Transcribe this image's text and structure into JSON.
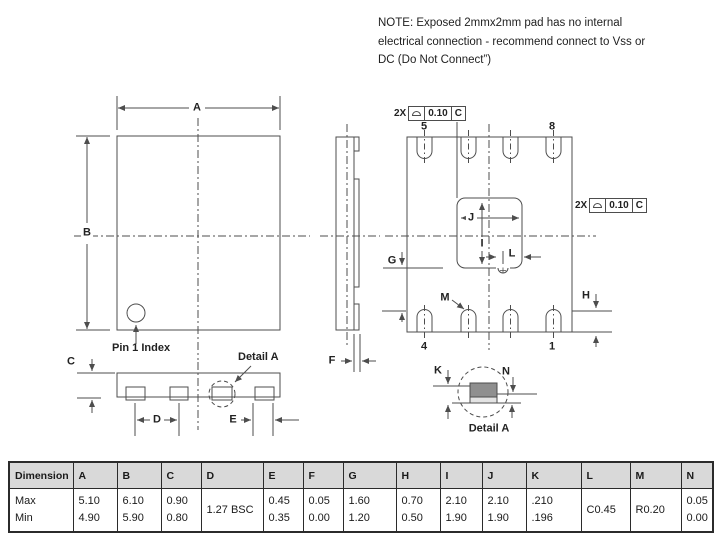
{
  "note": {
    "line1": "NOTE:  Exposed 2mmx2mm pad has no internal",
    "line2": "electrical connection - recommend connect to Vss or",
    "line3": "DC (Do Not Connect”)"
  },
  "drawing": {
    "labels": {
      "a": "A",
      "b": "B",
      "c": "C",
      "d": "D",
      "e": "E",
      "f": "F",
      "g": "G",
      "h": "H",
      "i": "I",
      "j": "J",
      "k": "K",
      "l": "L",
      "m": "M",
      "n": "N"
    },
    "pins": {
      "p1": "1",
      "p4": "4",
      "p5": "5",
      "p8": "8"
    },
    "pin1_index": "Pin 1 Index",
    "detail_a_pointer": "Detail A",
    "detail_a_caption": "Detail A",
    "callout": {
      "qty": "2X",
      "tolerance": "0.10",
      "datum": "C"
    }
  },
  "table": {
    "header": "Dimension",
    "row_labels": [
      "Max",
      "Min"
    ],
    "columns": [
      {
        "label": "A",
        "max": "5.10",
        "min": "4.90"
      },
      {
        "label": "B",
        "max": "6.10",
        "min": "5.90"
      },
      {
        "label": "C",
        "max": "0.90",
        "min": "0.80"
      },
      {
        "label": "D",
        "merged": "1.27 BSC"
      },
      {
        "label": "E",
        "max": "0.45",
        "min": "0.35"
      },
      {
        "label": "F",
        "max": "0.05",
        "min": "0.00"
      },
      {
        "label": "G",
        "max": "1.60",
        "min": "1.20"
      },
      {
        "label": "H",
        "max": "0.70",
        "min": "0.50"
      },
      {
        "label": "I",
        "max": "2.10",
        "min": "1.90"
      },
      {
        "label": "J",
        "max": "2.10",
        "min": "1.90"
      },
      {
        "label": "K",
        "max": ".210",
        "min": ".196"
      },
      {
        "label": "L",
        "merged": "C0.45"
      },
      {
        "label": "M",
        "merged": "R0.20"
      },
      {
        "label": "N",
        "max": "0.05",
        "min": "0.00"
      }
    ]
  },
  "colors": {
    "line": "#4d4d4d",
    "pad_dark": "#8f8f8f",
    "pad_light": "#e3e3e3",
    "table_header_bg": "#d9d9d9"
  }
}
